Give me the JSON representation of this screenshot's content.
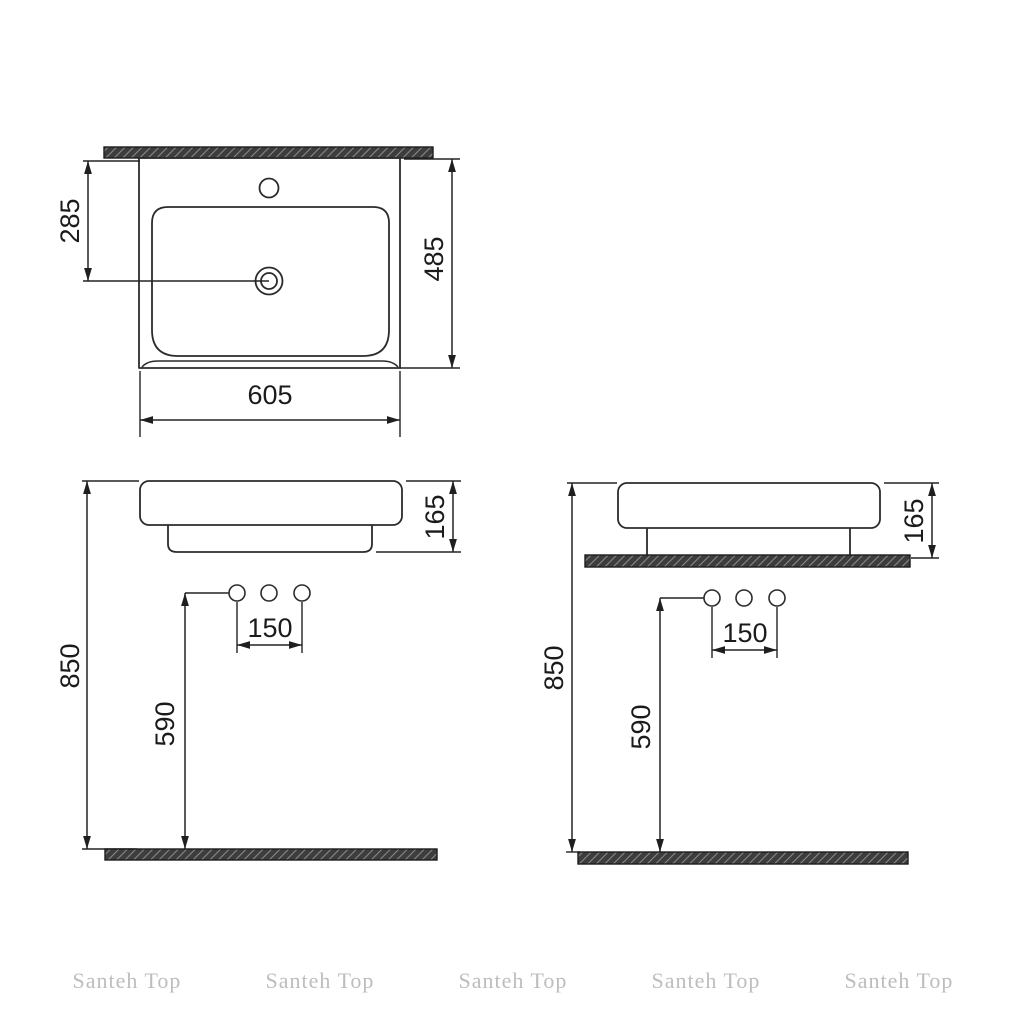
{
  "document": {
    "type": "washbasin technical drawing",
    "watermark": {
      "text": "Santeh Top",
      "count": 5
    },
    "colors": {
      "background": "#ffffff",
      "line": "#2b2b2b",
      "dimension_text": "#1b1b1b",
      "hatch_base": "#3d3d3d",
      "hatch_stripe": "#8a8a8a",
      "watermark": "#bdbdbd"
    }
  },
  "views": {
    "top": {
      "label": "top view",
      "dimensions": {
        "width": "605",
        "depth": "485",
        "drain_center_from_back": "285"
      }
    },
    "front_wall_hung": {
      "label": "front view wall-hung",
      "dimensions": {
        "rim_height_from_floor": "850",
        "basin_body_height": "165",
        "outlet_height_from_floor": "590",
        "outlet_spacing": "150"
      }
    },
    "front_on_counter": {
      "label": "front view on counter",
      "dimensions": {
        "rim_height_from_floor": "850",
        "basin_body_height": "165",
        "outlet_height_from_floor": "590",
        "outlet_spacing": "150"
      }
    }
  }
}
